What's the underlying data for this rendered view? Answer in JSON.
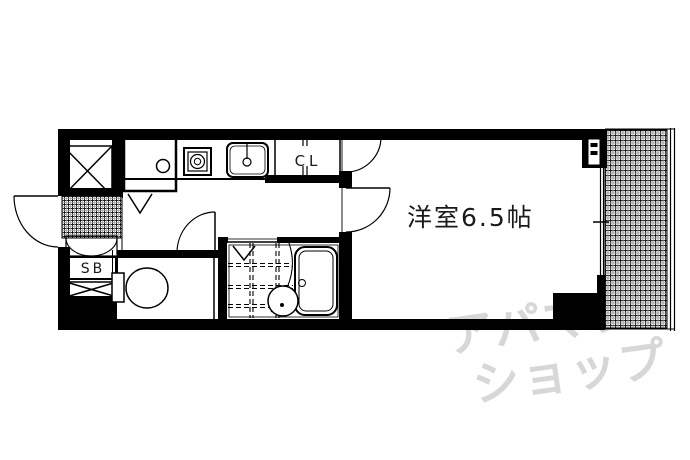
{
  "plan": {
    "room": {
      "label": "洋室6.5帖"
    },
    "closet": {
      "label": "CL"
    },
    "shoe_box": {
      "label": "SB"
    },
    "watermark": {
      "line1": "アパマン",
      "line2": "ショップ",
      "color": "#d7d7d7"
    },
    "colors": {
      "wall": "#000000",
      "line": "#1a1a1a",
      "hatch": "#222222"
    }
  }
}
